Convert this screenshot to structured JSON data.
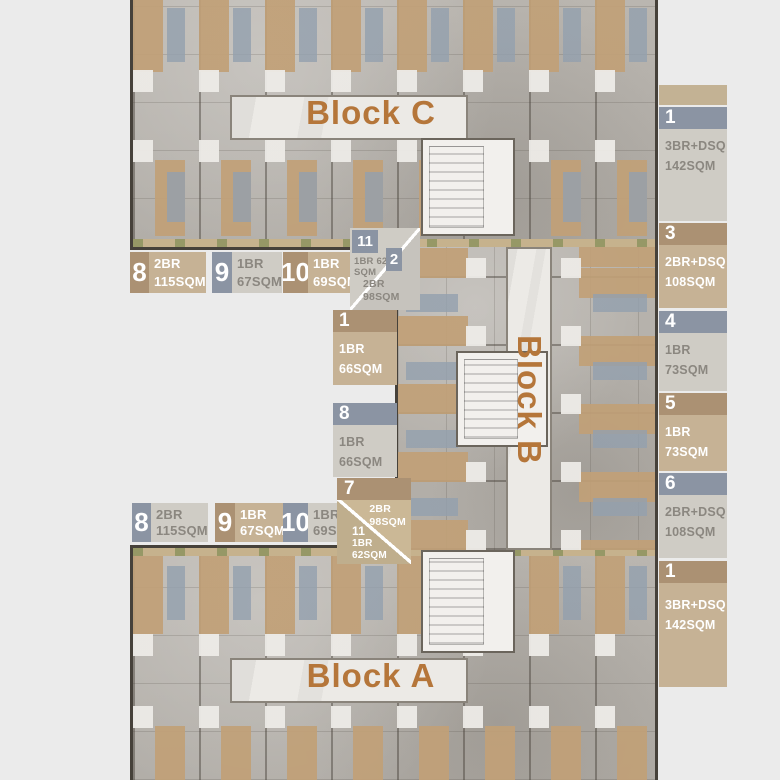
{
  "palette": {
    "background": "#ebebeb",
    "title_orange": "#b5763a",
    "tan_header": "#ab9173",
    "tan_body": "#c6b295",
    "slate_header": "#8b94a3",
    "gray_body": "#cfccc5",
    "gray_text": "#8b8780",
    "white_text": "#ffffff"
  },
  "blocks": {
    "c": {
      "title": "Block C"
    },
    "b": {
      "title": "Block B"
    },
    "a": {
      "title": "Block A"
    }
  },
  "top_row": [
    {
      "num": "8",
      "type": "2BR",
      "area": "115SQM",
      "scheme": "tan"
    },
    {
      "num": "9",
      "type": "1BR",
      "area": "67SQM",
      "scheme": "gray"
    },
    {
      "num": "10",
      "type": "1BR",
      "area": "69SQM",
      "scheme": "tan"
    }
  ],
  "top_corner": {
    "upper": {
      "num": "11",
      "line1": "1BR 62",
      "line2": "SQM"
    },
    "lower": {
      "num": "2",
      "line1": "2BR",
      "line2": "98SQM"
    }
  },
  "mid_column": [
    {
      "num": "1",
      "type": "1BR",
      "area": "66SQM",
      "scheme": "tan"
    },
    {
      "num": "8",
      "type": "1BR",
      "area": "66SQM",
      "scheme": "gray"
    }
  ],
  "bottom_corner": {
    "num": "7",
    "upper": {
      "line1": "2BR",
      "line2": "98SQM"
    },
    "lower": {
      "num": "11",
      "line1": "1BR",
      "line2": "62SQM"
    }
  },
  "bottom_row": [
    {
      "num": "8",
      "type": "2BR",
      "area": "115SQM",
      "scheme": "gray"
    },
    {
      "num": "9",
      "type": "1BR",
      "area": "67SQM",
      "scheme": "tan"
    },
    {
      "num": "10",
      "type": "1BR",
      "area": "69SQM",
      "scheme": "gray"
    }
  ],
  "right_column": [
    {
      "num": "1",
      "type": "3BR+DSQ",
      "area": "142SQM",
      "scheme": "gray"
    },
    {
      "num": "3",
      "type": "2BR+DSQ",
      "area": "108SQM",
      "scheme": "tan"
    },
    {
      "num": "4",
      "type": "1BR",
      "area": "73SQM",
      "scheme": "gray"
    },
    {
      "num": "5",
      "type": "1BR",
      "area": "73SQM",
      "scheme": "tan"
    },
    {
      "num": "6",
      "type": "2BR+DSQ",
      "area": "108SQM",
      "scheme": "gray"
    },
    {
      "num": "1",
      "type": "3BR+DSQ",
      "area": "142SQM",
      "scheme": "tan"
    }
  ]
}
